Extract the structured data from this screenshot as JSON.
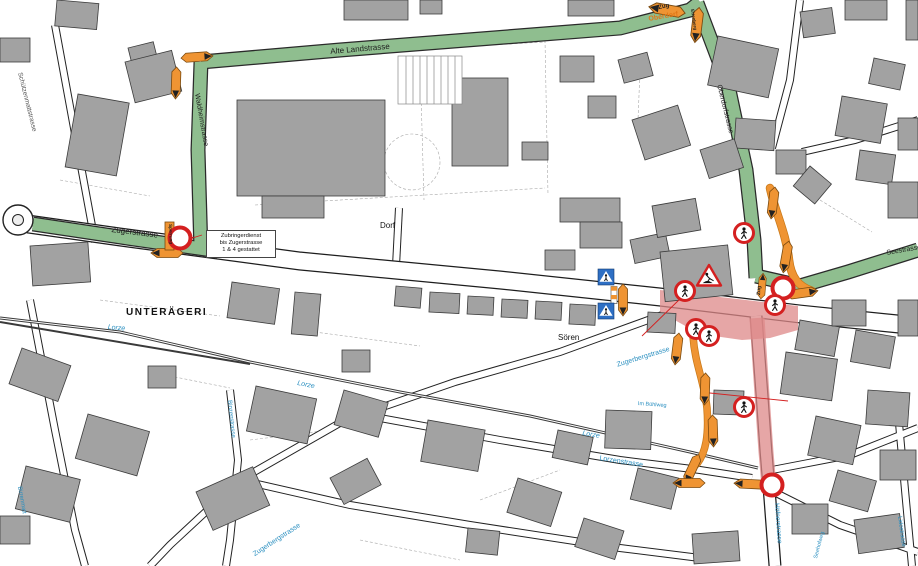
{
  "place_labels": {
    "unterageri": "UNTERÄGERI",
    "dorf": "Dorf",
    "soeren": "Sören",
    "oberdorf": "Oberdorf"
  },
  "street_labels": {
    "zugerstrasse": "Zugerstrasse",
    "alte_landstrasse": "Alte Landstrasse",
    "waldheimstrasse": "Waldheimstrasse",
    "schuetzenmattstrasse": "Schützenmattstrasse",
    "oberdorfstrasse": "Oberdorfstrasse",
    "seestrasse": "Seestrasse",
    "hoefnerstrasse": "Höfnerstrasse",
    "zugerbergstrasse": "Zugerbergstrasse",
    "lorzenstrasse": "Lorzenstrasse",
    "binzenstrasse": "Binzenstrasse",
    "birrenmatt": "Birrenmatt",
    "lidostrasse": "Lidostrasse",
    "im_buehlweg": "Im Bühlweg",
    "seehofweg": "Seehofweg"
  },
  "water_labels": {
    "lorze": "Lorze"
  },
  "direction_labels": {
    "zug": "Zug",
    "ettenberg": "Ettenberg",
    "sperrung": "Sperrung"
  },
  "note_box": {
    "line1": "Zubringerdienst",
    "line2": "bis Zugerstrasse",
    "line3": "1 & 4 gestattet"
  },
  "colors": {
    "detour_route_green": "#8fbe8f",
    "closed_route_red": "#dd8888",
    "marker_orange": "#ef9433",
    "prohibition_sign_red": "#d42020",
    "crosswalk_sign_blue": "#2e6fc4",
    "building_gray": "#a2a2a2",
    "street_label_blue": "#2a8fc0"
  }
}
